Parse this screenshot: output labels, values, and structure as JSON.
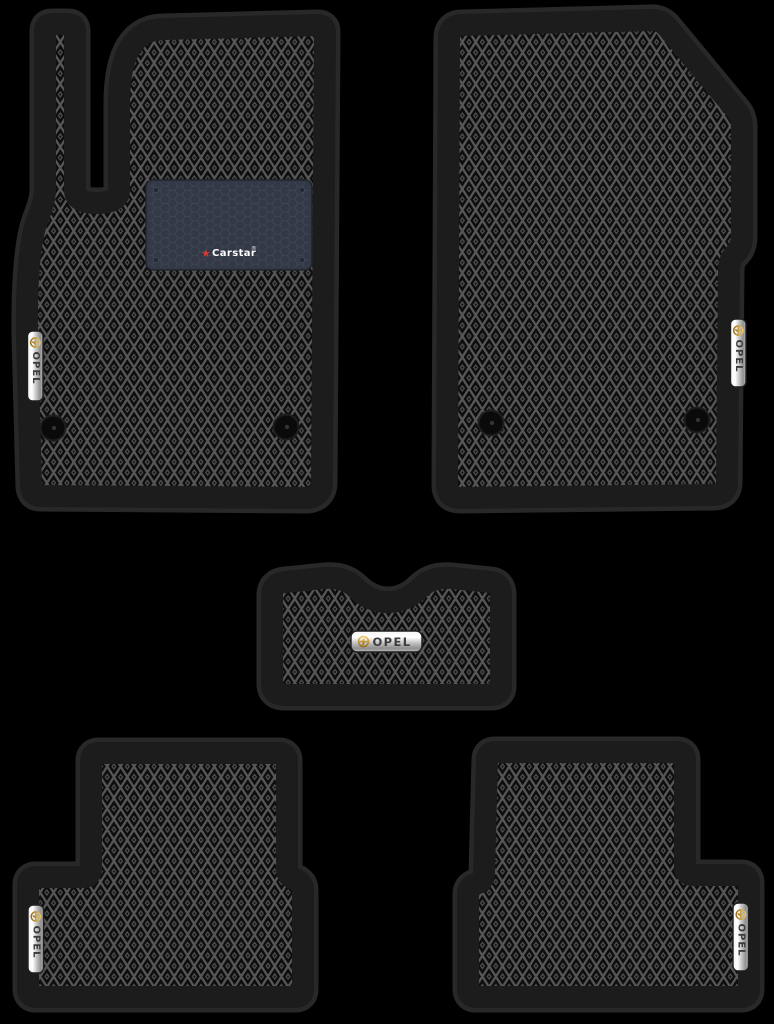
{
  "scene": {
    "type": "product-photo",
    "subject": "Set of 5 black EVA car floor mats with rhombus diamond pattern on black background",
    "background_color": "#000000",
    "mat_trim_color": "#1c1c1c"
  },
  "badges": {
    "label": "OPEL",
    "finish": "chrome-silver",
    "logo": "opel-blitz-icon",
    "logo_color": "#c9992f",
    "text_color": "#3c3c3c",
    "count": 5
  },
  "heel_pad": {
    "brand": "Carstar",
    "registered_mark": "®",
    "star_glyph": "★",
    "star_color": "#d23a32",
    "text_color": "#ffffff",
    "pad_color": "#333947",
    "texture": "honeycomb"
  },
  "mats": [
    {
      "name": "front-driver-mat",
      "position": "top-left",
      "badge": "OPEL",
      "features": [
        "footrest extension",
        "Carstar heel pad",
        "2 fastener clips",
        "vertical chrome badge"
      ]
    },
    {
      "name": "front-passenger-mat",
      "position": "top-right",
      "badge": "OPEL",
      "features": [
        "clipped top-right corner",
        "2 fastener clips",
        "vertical chrome badge"
      ]
    },
    {
      "name": "center-tunnel-mat",
      "position": "middle",
      "badge": "OPEL",
      "features": [
        "concave top notch",
        "horizontal chrome badge"
      ]
    },
    {
      "name": "rear-left-mat",
      "position": "bottom-left",
      "badge": "OPEL",
      "features": [
        "stepped left side",
        "vertical chrome badge"
      ]
    },
    {
      "name": "rear-right-mat",
      "position": "bottom-right",
      "badge": "OPEL",
      "features": [
        "stepped right side",
        "vertical chrome badge"
      ]
    }
  ],
  "pattern": {
    "style": "diamond-rhombus EVA cells with center dots",
    "cell_color": "#0d0d0d",
    "line_color": "#575757"
  }
}
